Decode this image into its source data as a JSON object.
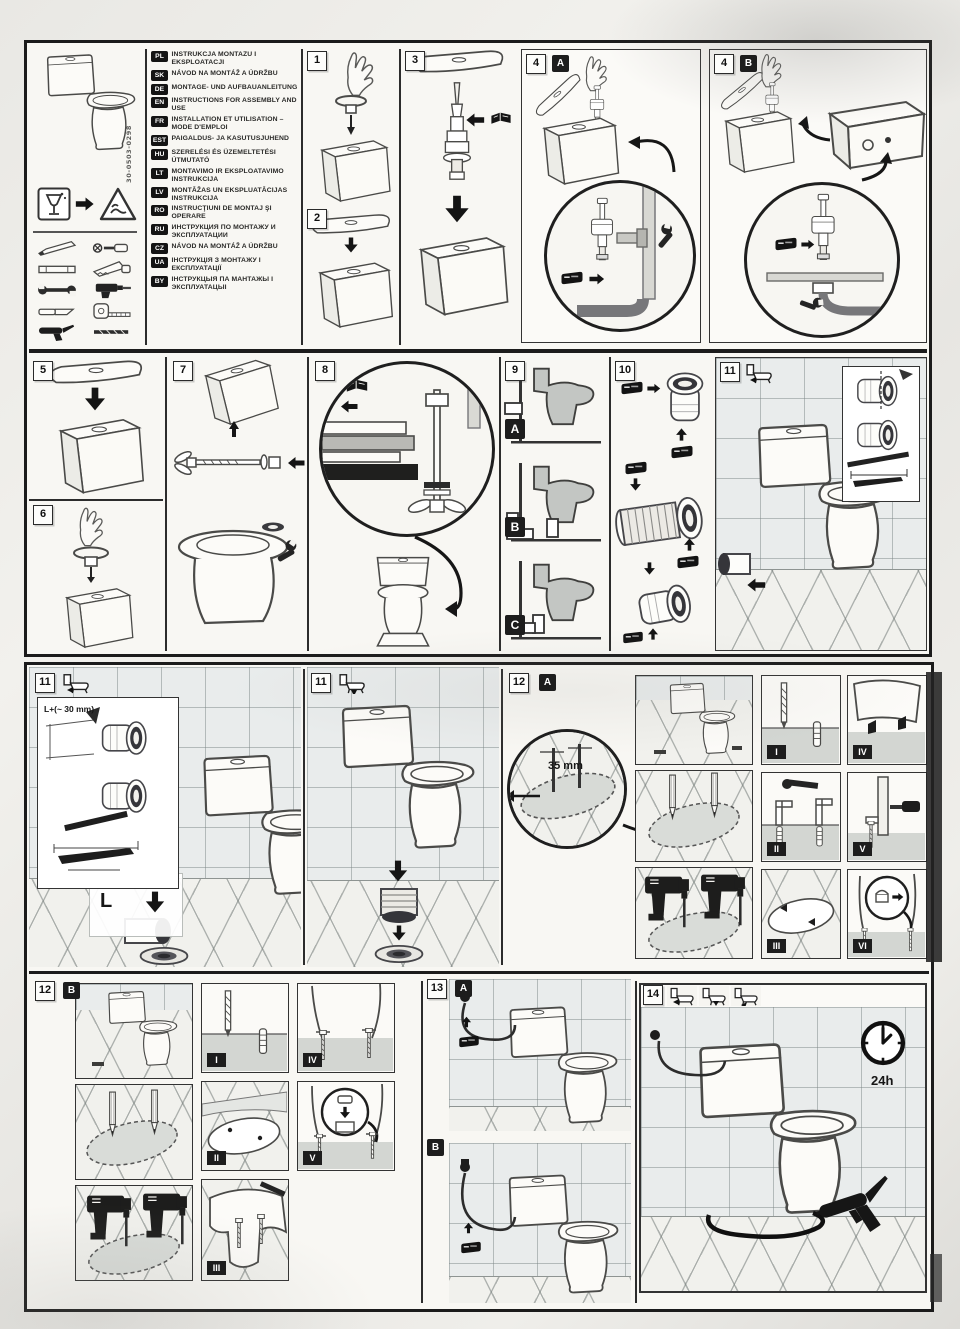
{
  "document": {
    "type": "toilet installation and assembly leaflet (scanned)",
    "part_code": "30-0503-0298"
  },
  "languages": [
    {
      "code": "PL",
      "text": "INSTRUKCJA MONTAŻU I EKSPLOATACJI"
    },
    {
      "code": "SK",
      "text": "NÁVOD NA MONTÁŽ A ÚDRŽBU"
    },
    {
      "code": "DE",
      "text": "MONTAGE- UND AUFBAUANLEITUNG"
    },
    {
      "code": "EN",
      "text": "INSTRUCTIONS FOR ASSEMBLY AND USE"
    },
    {
      "code": "FR",
      "text": "INSTALLATION ET UTILISATION – MODE D'EMPLOI"
    },
    {
      "code": "EST",
      "text": "PAIGALDUS- JA KASUTUSJUHEND"
    },
    {
      "code": "HU",
      "text": "SZERELÉSI ÉS ÜZEMELTETÉSI ÚTMUTATÓ"
    },
    {
      "code": "LT",
      "text": "MONTAVIMO IR EKSPLOATAVIMO INSTRUKCIJA"
    },
    {
      "code": "LV",
      "text": "MONTĀŽAS UN EKSPLUATĀCIJAS INSTRUKCIJA"
    },
    {
      "code": "RO",
      "text": "INSTRUCŢIUNI DE MONTAJ ŞI OPERARE"
    },
    {
      "code": "RU",
      "text": "ИНСТРУКЦИЯ ПО МОНТАЖУ И ЭКСПЛУАТАЦИИ"
    },
    {
      "code": "CZ",
      "text": "NÁVOD NA MONTÁŽ A ÚDRŽBU"
    },
    {
      "code": "UA",
      "text": "ІНСТРУКЦІЯ З МОНТАЖУ І ЕКСПЛУАТАЦІЇ"
    },
    {
      "code": "BY",
      "text": "ІНСТРУКЦЫЯ ПА МАНТАЖЫ І ЭКСПЛУАТАЦЫІ"
    }
  ],
  "steps": {
    "s1": "1",
    "s2": "2",
    "s3": "3",
    "s4": "4",
    "s5": "5",
    "s6": "6",
    "s7": "7",
    "s8": "8",
    "s9": "9",
    "s10": "10",
    "s11": "11",
    "s12": "12",
    "s13": "13",
    "s14": "14"
  },
  "variants": {
    "a": "A",
    "b": "B",
    "c": "C"
  },
  "romans": [
    "I",
    "II",
    "III",
    "IV",
    "V",
    "VI"
  ],
  "annotations": {
    "drill_depth": "35 mm",
    "cut_length": "L+(~ 30 mm)",
    "length_mark": "L",
    "cure_time": "24h"
  }
}
